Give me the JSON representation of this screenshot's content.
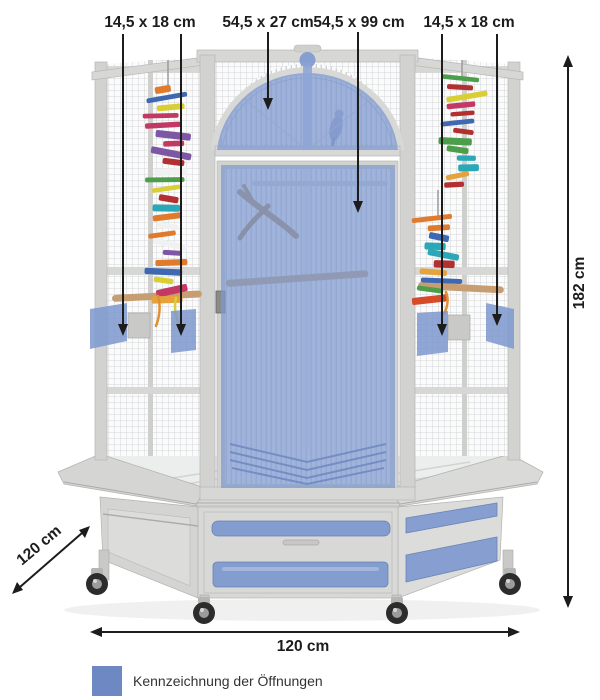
{
  "annotations": {
    "top_labels": [
      {
        "label": "14,5 x 18 cm",
        "target": "left-side-openings"
      },
      {
        "label": "54,5 x 27 cm",
        "target": "arch-window-opening"
      },
      {
        "label": "54,5 x 99 cm",
        "target": "front-door-opening"
      },
      {
        "label": "14,5 x 18 cm",
        "target": "right-side-openings"
      }
    ],
    "height_label": "182 cm",
    "depth_label": "120 cm",
    "width_label": "120 cm"
  },
  "legend": {
    "swatch_color": "#6d88c3",
    "label": "Kennzeichnung der Öffnungen"
  },
  "colors": {
    "highlight": "#7d98cf",
    "frame": "#d2d3d1",
    "mesh_line": "#c9cccd",
    "arrow": "#1c1c1c",
    "background": "#ffffff"
  }
}
